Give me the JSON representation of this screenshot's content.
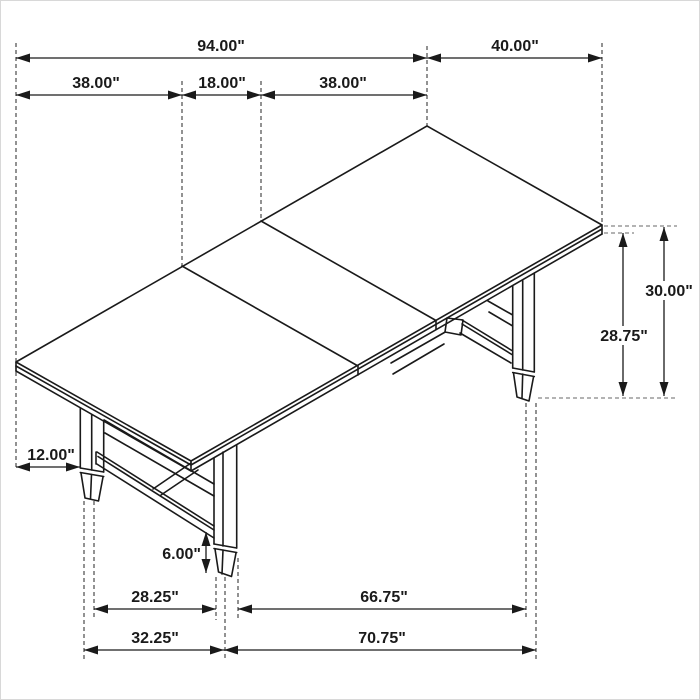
{
  "drawing": {
    "subject": "trestle-dining-table-dimension-diagram",
    "unit": "inches",
    "line_color": "#1a1a1a",
    "extension_line_color": "#4a4a4a",
    "reference_line_color": "#9a9a9a",
    "dimensions_horizontal": [
      {
        "name": "overall-length",
        "label": "94.00\"",
        "value": 94.0,
        "x1": 15,
        "x2": 426,
        "y": 57,
        "label_x": 220,
        "label_y": 50
      },
      {
        "name": "top-width",
        "label": "40.00\"",
        "value": 40.0,
        "x1": 426,
        "x2": 601,
        "y": 57,
        "label_x": 514,
        "label_y": 50
      },
      {
        "name": "end-section-left",
        "label": "38.00\"",
        "value": 38.0,
        "x1": 15,
        "x2": 181,
        "y": 94,
        "label_x": 95,
        "label_y": 87
      },
      {
        "name": "center-leaf",
        "label": "18.00\"",
        "value": 18.0,
        "x1": 181,
        "x2": 260,
        "y": 94,
        "label_x": 221,
        "label_y": 87
      },
      {
        "name": "end-section-right",
        "label": "38.00\"",
        "value": 38.0,
        "x1": 260,
        "x2": 426,
        "y": 94,
        "label_x": 342,
        "label_y": 87
      },
      {
        "name": "leg-inset-from-end",
        "label": "12.00\"",
        "value": 12.0,
        "x1": 15,
        "x2": 79,
        "y": 466,
        "label_x": 50,
        "label_y": 459
      },
      {
        "name": "feet-spacing-inner-width",
        "label": "28.25\"",
        "value": 28.25,
        "x1": 93,
        "x2": 215,
        "y": 608,
        "label_x": 154,
        "label_y": 601
      },
      {
        "name": "feet-spacing-inner-length",
        "label": "66.75\"",
        "value": 66.75,
        "x1": 237,
        "x2": 525,
        "y": 608,
        "label_x": 383,
        "label_y": 601
      },
      {
        "name": "feet-spacing-outer-width",
        "label": "32.25\"",
        "value": 32.25,
        "x1": 83,
        "x2": 223,
        "y": 649,
        "label_x": 154,
        "label_y": 642
      },
      {
        "name": "feet-spacing-outer-length",
        "label": "70.75\"",
        "value": 70.75,
        "x1": 223,
        "x2": 535,
        "y": 649,
        "label_x": 381,
        "label_y": 642
      }
    ],
    "dimensions_vertical": [
      {
        "name": "height-under-top",
        "label": "28.75\"",
        "value": 28.75,
        "x": 622,
        "y1": 232,
        "y2": 395,
        "label_x": 623,
        "label_y": 340,
        "label_anchor": "middle",
        "label_bg": true
      },
      {
        "name": "overall-height",
        "label": "30.00\"",
        "value": 30.0,
        "x": 663,
        "y1": 226,
        "y2": 395,
        "label_x": 668,
        "label_y": 295,
        "label_anchor": "middle",
        "label_bg": true
      },
      {
        "name": "foot-height",
        "label": "6.00\"",
        "value": 6.0,
        "x": 205,
        "y1": 531,
        "y2": 572,
        "label_x": 200,
        "label_y": 558,
        "label_anchor": "end",
        "label_bg": false
      }
    ],
    "extension_lines_vertical": [
      [
        15,
        42,
        466
      ],
      [
        181,
        80,
        265
      ],
      [
        260,
        80,
        220
      ],
      [
        426,
        45,
        125
      ],
      [
        601,
        42,
        224
      ],
      [
        83,
        500,
        660
      ],
      [
        93,
        500,
        619
      ],
      [
        215,
        576,
        619
      ],
      [
        224,
        576,
        660
      ],
      [
        237,
        557,
        619
      ],
      [
        525,
        402,
        619
      ],
      [
        535,
        402,
        660
      ]
    ],
    "extension_lines_horizontal": [
      {
        "x1": 603,
        "x2": 676,
        "y": 225,
        "style": "gray"
      },
      {
        "x1": 603,
        "x2": 633,
        "y": 232,
        "style": "gray"
      },
      {
        "x1": 537,
        "x2": 676,
        "y": 397,
        "style": "gray"
      }
    ]
  }
}
